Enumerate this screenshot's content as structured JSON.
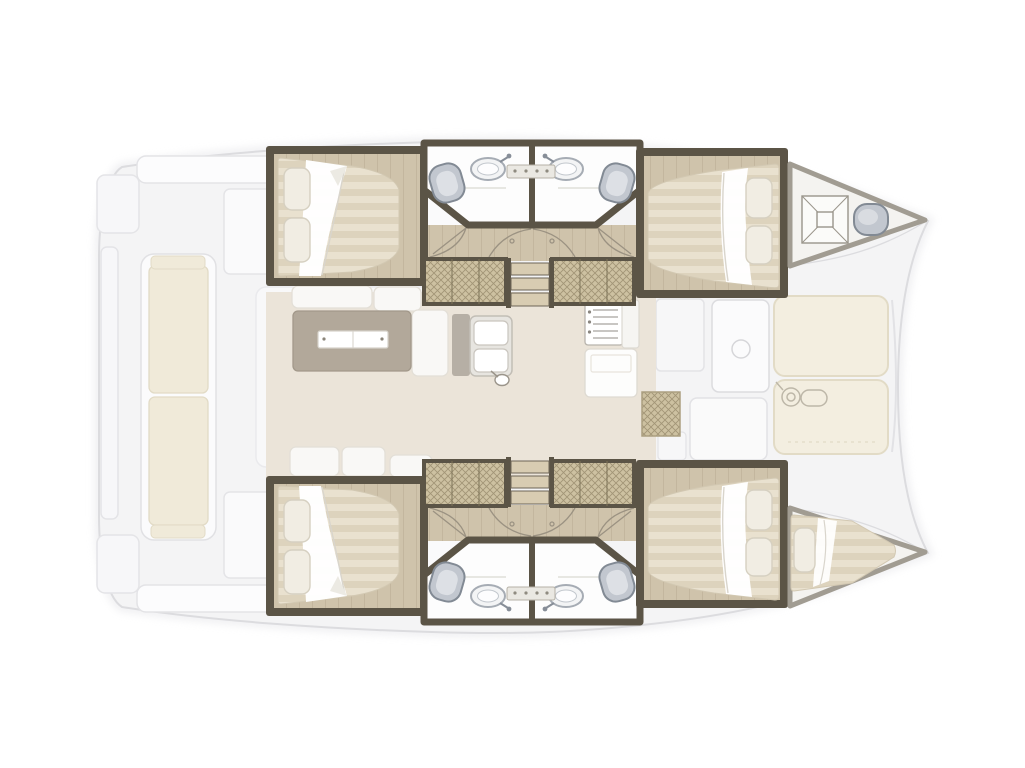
{
  "palette": {
    "deck": "#f4f4f5",
    "deck_line": "#dcdcdf",
    "cockpit_white": "#fbfbfc",
    "cushion": "#f0ead9",
    "cream": "#f3eee0",
    "cream_line": "#e2dbc6",
    "wall": "#5b5446",
    "wood": "#cfc3ab",
    "wood_line": "#bdb098",
    "bridge_floor": "#ebe4d9",
    "mattress": "#e9e1cf",
    "mattress_stripe": "#ddd3bd",
    "sheet": "#ffffff",
    "pillow": "#f1ede3",
    "pillow_line": "#d6d0c1",
    "bath_floor": "#fdfdfd",
    "fixture": "#c2c7cf",
    "fixture_line": "#828a94",
    "table": "#b2a89a",
    "hatch_fill": "#cdc1a1",
    "hatch_line": "#97896b",
    "step": "#d8ccb2",
    "arc": "#9b9282",
    "white_furniture": "#f9f8f6",
    "furniture_line": "#e3dfd7"
  },
  "plan": {
    "type": "catamaran-interior-floor-plan",
    "orientation": {
      "bow": "right",
      "stern": "left",
      "port_hull": "top",
      "starboard_hull": "bottom"
    },
    "rooms": [
      {
        "name": "aft-cockpit",
        "position": "stern",
        "features": [
          "bench-seat",
          "side-seats"
        ]
      },
      {
        "name": "salon",
        "position": "bridgedeck-center",
        "features": [
          "sofa",
          "table-with-leaf"
        ]
      },
      {
        "name": "galley",
        "position": "bridgedeck-forward",
        "features": [
          "double-sink",
          "stove",
          "counter"
        ]
      },
      {
        "name": "port-aft-double-cabin",
        "pillows": 2
      },
      {
        "name": "port-aft-bathroom",
        "fixtures": [
          "sink",
          "toilet"
        ]
      },
      {
        "name": "port-fwd-bathroom",
        "fixtures": [
          "sink",
          "toilet"
        ]
      },
      {
        "name": "port-fwd-double-cabin",
        "pillows": 2
      },
      {
        "name": "port-forepeak",
        "features": [
          "deck-hatch",
          "fixture"
        ]
      },
      {
        "name": "starboard-aft-double-cabin",
        "pillows": 2
      },
      {
        "name": "starboard-aft-bathroom",
        "fixtures": [
          "sink",
          "toilet"
        ]
      },
      {
        "name": "starboard-fwd-bathroom",
        "fixtures": [
          "sink",
          "toilet"
        ]
      },
      {
        "name": "starboard-fwd-double-cabin",
        "pillows": 2
      },
      {
        "name": "starboard-bow-berth",
        "pillows": 1
      },
      {
        "name": "fwd-cockpit",
        "position": "bridgedeck-bow",
        "features": [
          "door",
          "threshold-mat"
        ]
      },
      {
        "name": "foredeck-sunpads",
        "panels": 2,
        "features": [
          "winch"
        ]
      }
    ],
    "counts": {
      "hulls": 2,
      "double_cabins": 4,
      "bathrooms": 4,
      "toilets": 4,
      "bathroom_sinks": 4,
      "galley_sink_basins": 2,
      "companionway_steps": 2,
      "wardrobes": 4,
      "deck_hatches": 1,
      "bow_berths": 1
    },
    "icons": [
      "sink-icon",
      "toilet-icon",
      "stove-icon",
      "deck-hatch-icon",
      "winch-icon",
      "door-swing-icon",
      "steps-icon"
    ]
  }
}
